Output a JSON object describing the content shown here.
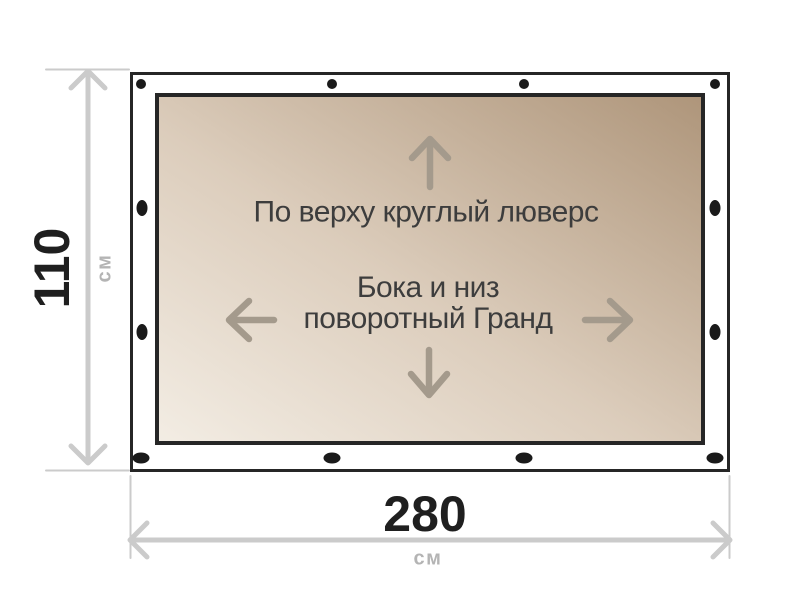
{
  "diagram": {
    "title": "tarp-grommet-layout",
    "notes": {
      "top_edge": "По верху круглый люверс",
      "center_line1": "Бока и низ",
      "center_line2": "поворотный Гранд"
    },
    "dimensions": {
      "height_value": "110",
      "height_unit": "см",
      "width_value": "280",
      "width_unit": "см"
    },
    "grommets": {
      "count": 12
    },
    "colors": {
      "frame_border": "#262626",
      "grommet": "#1a1a1a",
      "tarp_gradient_light": "#f3ede4",
      "tarp_gradient_mid": "#dccdbc",
      "tarp_gradient_dark": "#ae957a",
      "dimension_gray": "#cbcbcb",
      "unit_gray": "#b4b4b4",
      "note_text": "#3d3d3d",
      "direction_arrow": "#a49a8c"
    }
  }
}
